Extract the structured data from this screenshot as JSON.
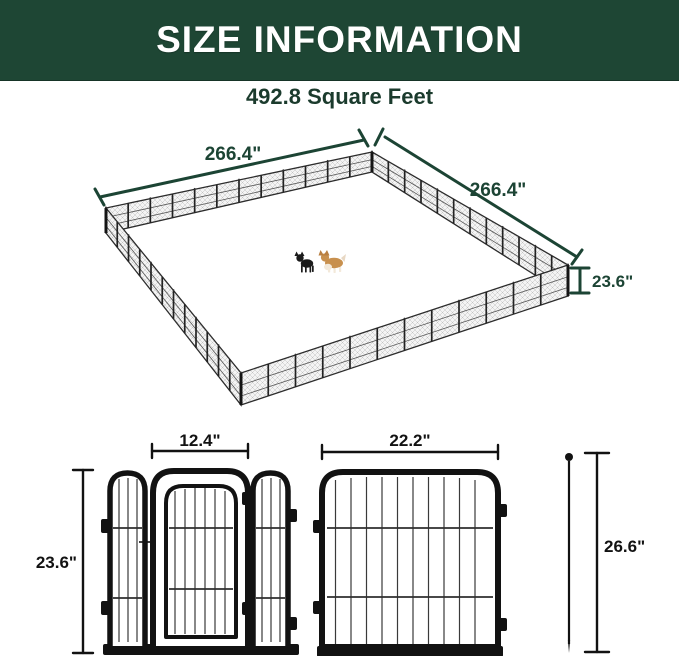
{
  "header": {
    "title": "SIZE INFORMATION"
  },
  "subtitle": "492.8 Square Feet",
  "enclosure": {
    "width_left": "266.4\"",
    "width_right": "266.4\"",
    "height": "23.6\""
  },
  "components": {
    "door_panel_width": "12.4\"",
    "panel_height": "23.6\"",
    "panel_width": "22.2\"",
    "stake_height": "26.6\""
  },
  "icons": {
    "black_dog": "black-dog-icon",
    "corgi_dog": "corgi-dog-icon",
    "ground_stake": "ground-stake-icon"
  },
  "colors": {
    "header_bg": "#1E4634",
    "accent_green": "#1C4434",
    "ink": "#121212",
    "mesh_gray": "#C2C2C2"
  }
}
